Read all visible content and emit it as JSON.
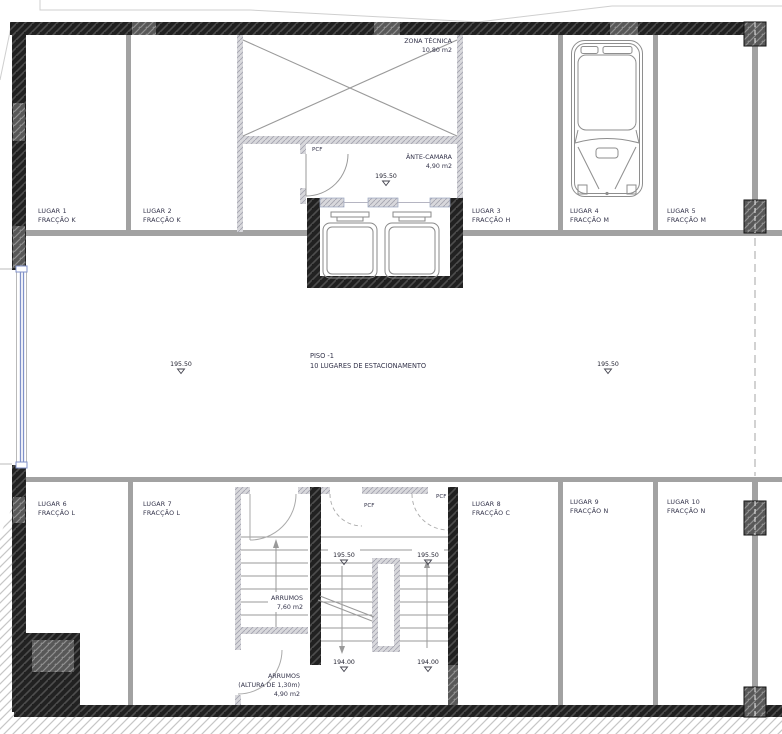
{
  "floor": {
    "label": "PISO -1",
    "sublabel": "10  LUGARES  DE  ESTACIONAMENTO"
  },
  "levels": {
    "upper": "195.50",
    "lower": "194.00"
  },
  "door_label": "PCF",
  "rooms": {
    "zona_tecnica": {
      "name": "ZONA TÉCNICA",
      "area": "10,80 m2"
    },
    "ante_camara": {
      "name": "ÂNTE-CAMARA",
      "area": "4,90 m2"
    },
    "arrumos_upper": {
      "name": "ARRUMOS",
      "area": "7,60 m2"
    },
    "arrumos_lower": {
      "name": "ARRUMOS",
      "note": "(ALTURA DE 1,30m)",
      "area": "4,90 m2"
    }
  },
  "parking_spaces": [
    {
      "lugar": "LUGAR  1",
      "fraccao": "FRACÇÃO  K"
    },
    {
      "lugar": "LUGAR  2",
      "fraccao": "FRACÇÃO  K"
    },
    {
      "lugar": "LUGAR  3",
      "fraccao": "FRACÇÃO  H"
    },
    {
      "lugar": "LUGAR  4",
      "fraccao": "FRACÇÃO  M"
    },
    {
      "lugar": "LUGAR  5",
      "fraccao": "FRACÇÃO  M"
    },
    {
      "lugar": "LUGAR  6",
      "fraccao": "FRACÇÃO  L"
    },
    {
      "lugar": "LUGAR  7",
      "fraccao": "FRACÇÃO  L"
    },
    {
      "lugar": "LUGAR  8",
      "fraccao": "FRACÇÃO  C"
    },
    {
      "lugar": "LUGAR  9",
      "fraccao": "FRACÇÃO  N"
    },
    {
      "lugar": "LUGAR  10",
      "fraccao": "FRACÇÃO  N"
    }
  ]
}
